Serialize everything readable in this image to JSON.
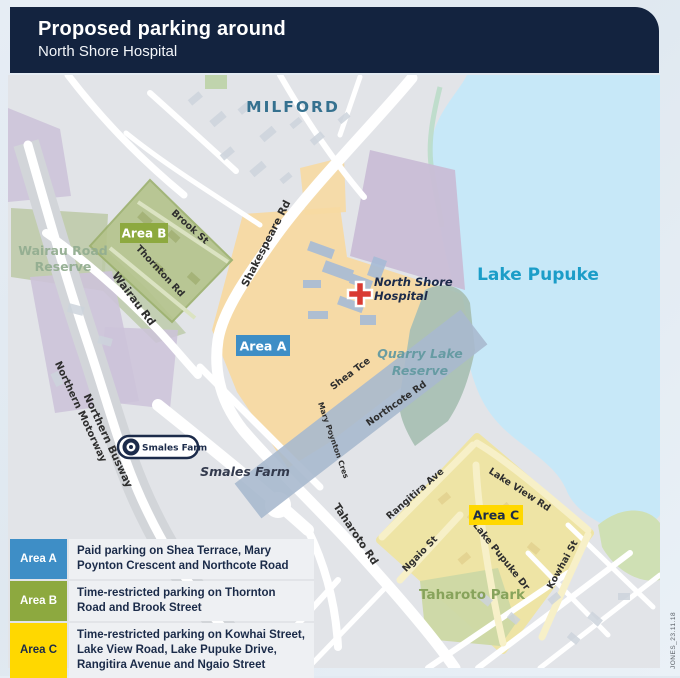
{
  "header": {
    "title": "Proposed parking around",
    "subtitle": "North Shore Hospital"
  },
  "map": {
    "place_labels": {
      "milford": "MILFORD",
      "lake_pupuke": "Lake Pupuke",
      "wairau_reserve_line1": "Wairau Road",
      "wairau_reserve_line2": "Reserve",
      "quarry_line1": "Quarry Lake",
      "quarry_line2": "Reserve",
      "hospital_line1": "North Shore",
      "hospital_line2": "Hospital",
      "smales_farm": "Smales Farm",
      "taharoto_park": "Taharoto Park"
    },
    "road_labels": {
      "brook_st": "Brook St",
      "thornton_rd": "Thornton Rd",
      "shakespeare_rd": "Shakespeare Rd",
      "wairau_rd": "Wairau Rd",
      "northern_busway": "Northern Busway",
      "northern_motorway": "Northern Motorway",
      "shea_tce": "Shea Tce",
      "mary_poynton_cres": "Mary Poynton Cres",
      "northcote_rd": "Northcote Rd",
      "taharoto_rd": "Taharoto Rd",
      "rangitira_ave": "Rangitira Ave",
      "lake_view_rd": "Lake View Rd",
      "ngaio_st": "Ngaio St",
      "lake_pupuke_dr": "Lake Pupuke Dr",
      "kowhai_st": "Kowhai St"
    },
    "area_markers": {
      "a": "Area A",
      "b": "Area B",
      "c": "Area C"
    },
    "station_badge": "Smales Farm",
    "colors": {
      "header_navy": "#13233f",
      "water": "#c7e8f8",
      "land": "#e2e4e8",
      "area_a_fill": "#f7d9a2",
      "area_b_fill": "#b4c38b",
      "area_c_fill": "#efe4a2",
      "area_a_badge": "#3e8ec6",
      "area_b_badge": "#8da93f",
      "area_c_badge": "#ffd800",
      "hospital_cross_red": "#d93a32",
      "milford_text": "#35718f",
      "lake_text": "#1b9dc8"
    }
  },
  "legend": {
    "items": [
      {
        "label": "Area A",
        "description": "Paid parking on Shea Terrace, Mary Poynton Crescent and Northcote Road"
      },
      {
        "label": "Area B",
        "description": "Time-restricted parking on Thornton Road and Brook Street"
      },
      {
        "label": "Area C",
        "description": "Time-restricted parking on Kowhai Street, Lake View Road, Lake Pupuke Drive, Rangitira Avenue and Ngaio Street"
      }
    ]
  },
  "credit": "JONES_23.11.18"
}
